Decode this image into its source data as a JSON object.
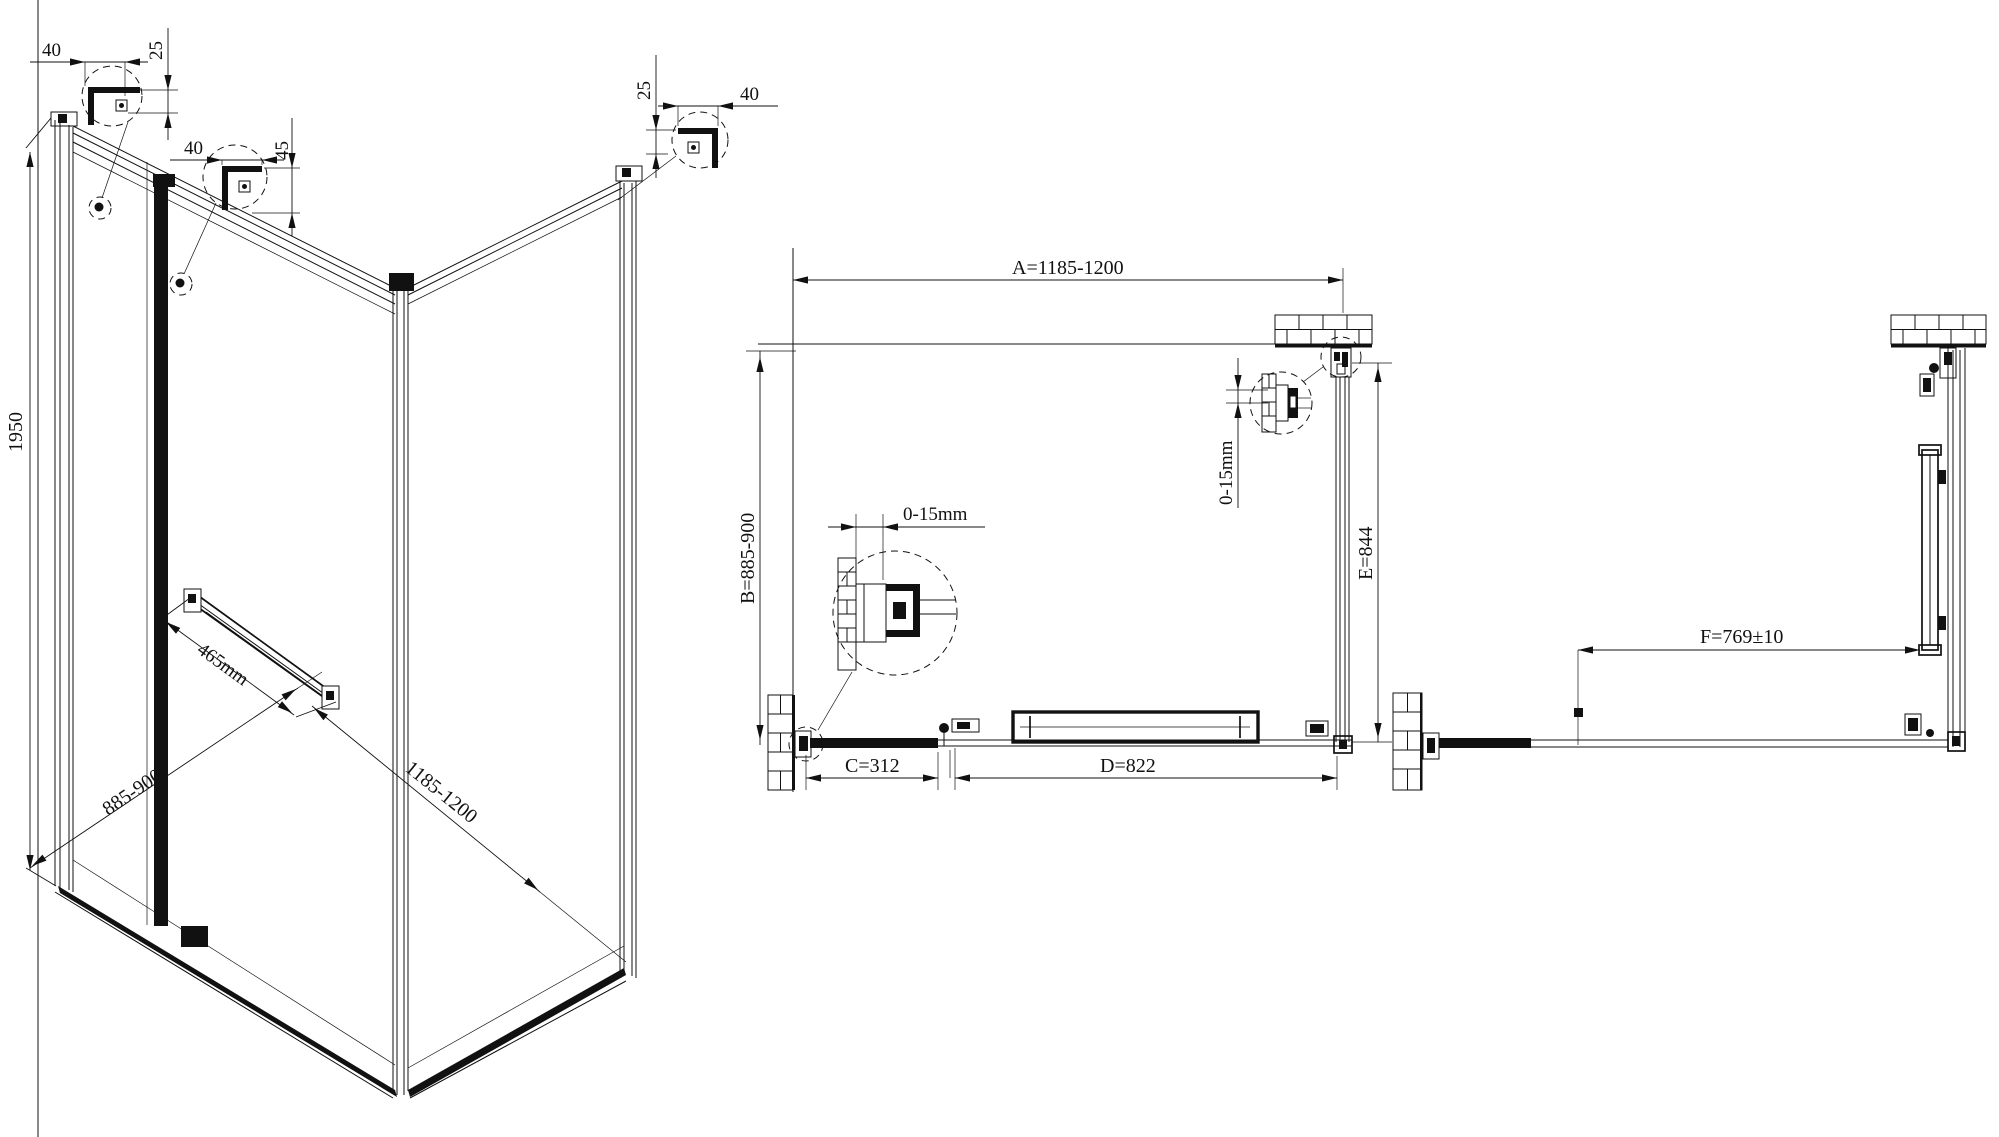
{
  "background": "#ffffff",
  "line_color": "#111111",
  "iso_view": {
    "height_label": "1950",
    "depth_label": "885-900",
    "width_label": "1185-1200",
    "towel_bar_label": "465mm"
  },
  "detail_circles": {
    "top_left": {
      "width": "40",
      "height": "25"
    },
    "middle": {
      "width": "40",
      "height": "45"
    },
    "right": {
      "height": "25",
      "width": "40"
    }
  },
  "plan_view": {
    "width_label": "A=1185-1200",
    "depth_label": "B=885-900",
    "door_segment_label": "C=312",
    "fixed_panel_label": "D=822",
    "inner_depth_label": "E=844",
    "wall_adjust_top": "0-15mm",
    "wall_adjust_left": "0-15mm"
  },
  "side_view": {
    "width_label": "F=769±10"
  }
}
